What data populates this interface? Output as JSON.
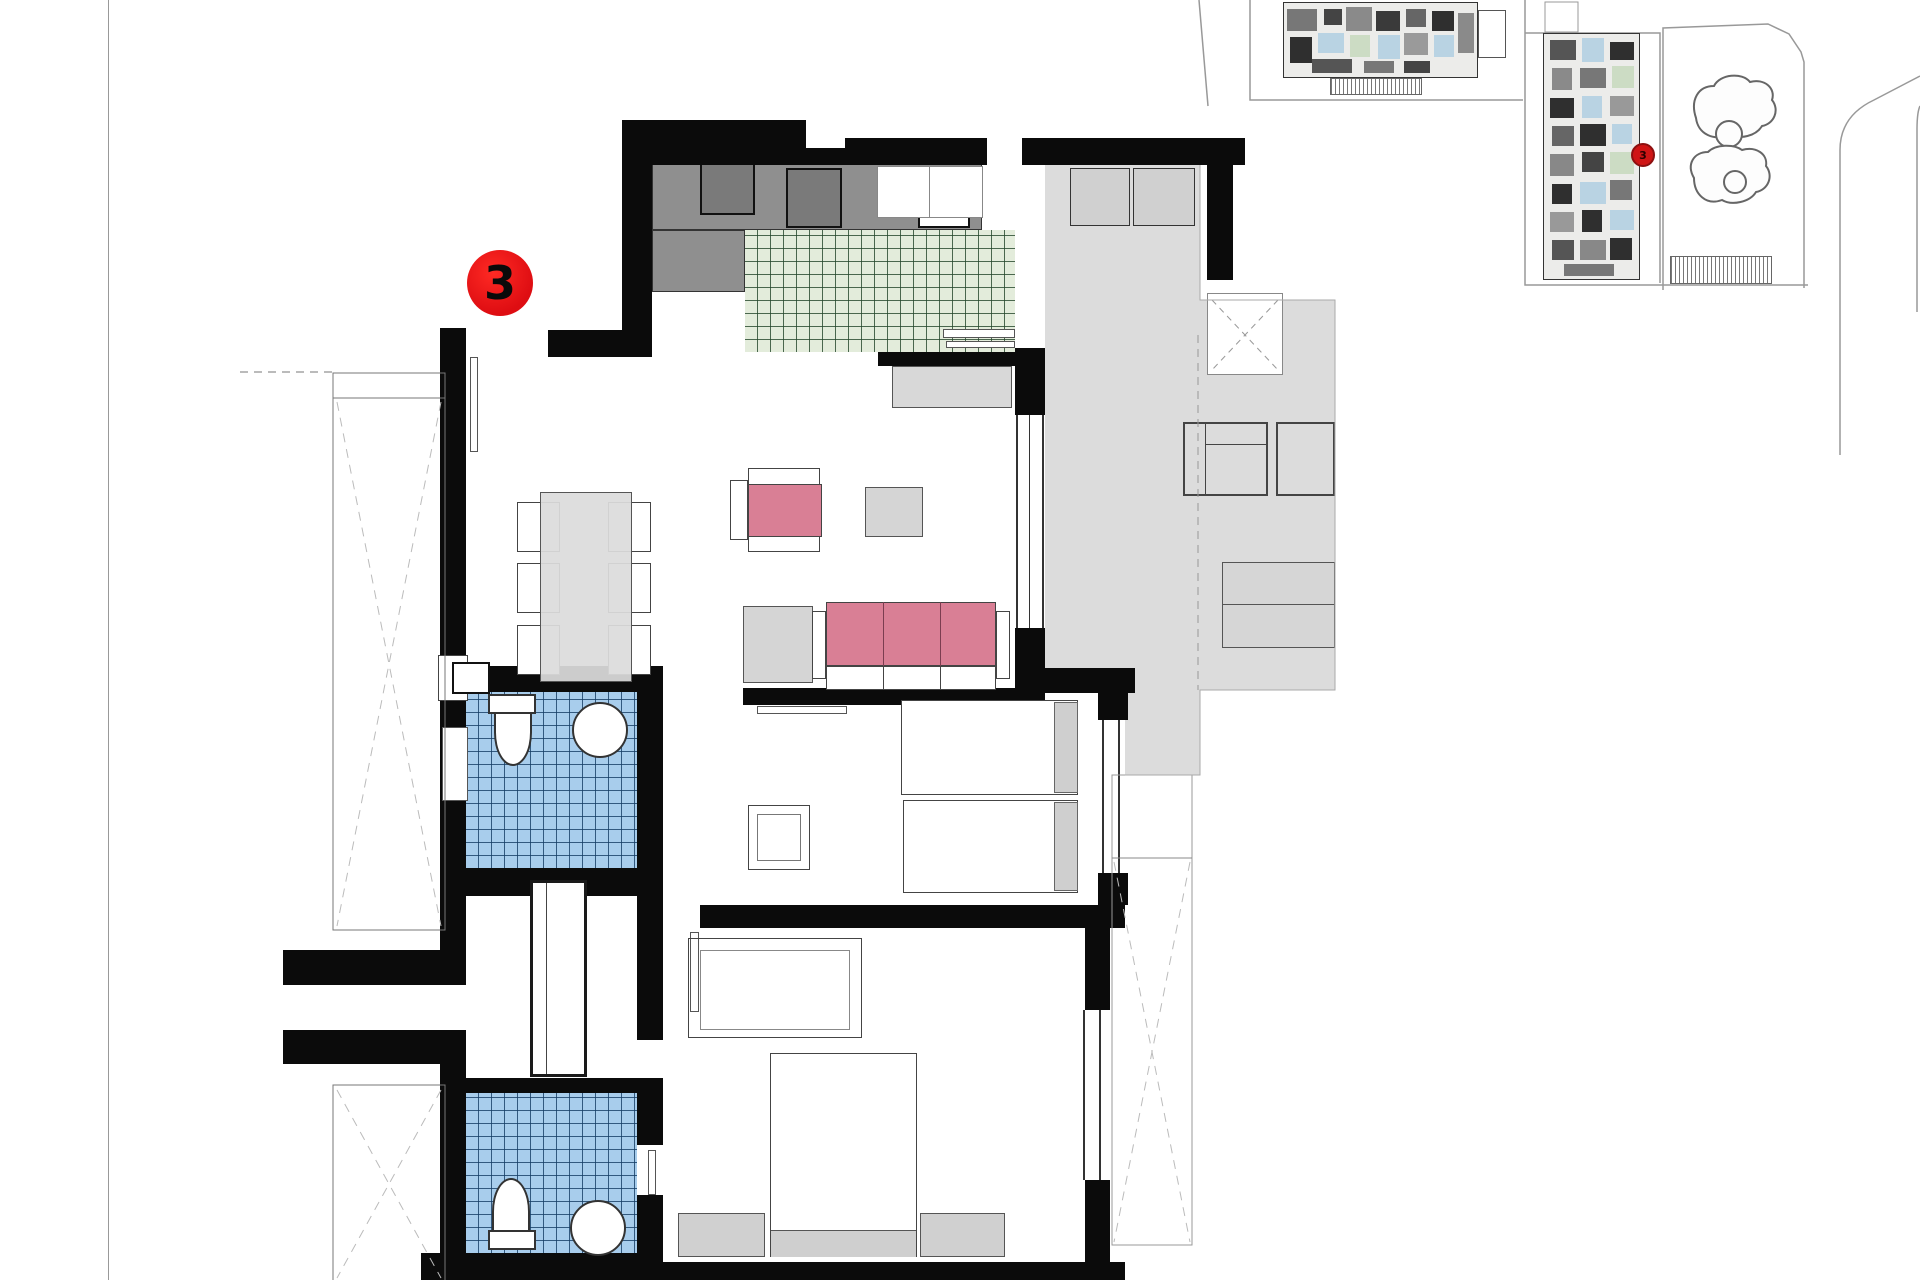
{
  "unit_badge": {
    "label": "3"
  },
  "site_plan": {
    "badge_label": "3"
  },
  "palette": {
    "wall": "#0b0b0b",
    "kitchen_tile_green": "#e3ecdb",
    "bathroom_tile_blue": "#a8cdec",
    "terrace_gray": "#dcdcdc",
    "counter_gray": "#8f8f8f",
    "upholstery_pink": "#d97f95",
    "badge_red": "#de0d12"
  },
  "rooms": [
    {
      "name": "kitchen"
    },
    {
      "name": "living-dining"
    },
    {
      "name": "covered-terrace"
    },
    {
      "name": "open-terrace"
    },
    {
      "name": "bathroom-1"
    },
    {
      "name": "bathroom-2"
    },
    {
      "name": "bedroom-1-twin"
    },
    {
      "name": "bedroom-2-double"
    },
    {
      "name": "hall-lobby"
    },
    {
      "name": "light-well-shafts"
    }
  ],
  "furniture": [
    {
      "name": "dining-table-6-chairs"
    },
    {
      "name": "sofa-3-seat-pink"
    },
    {
      "name": "armchair-pink"
    },
    {
      "name": "coffee-tables"
    },
    {
      "name": "twin-beds"
    },
    {
      "name": "double-bed"
    },
    {
      "name": "wardrobe"
    },
    {
      "name": "kitchen-counter-appliances"
    },
    {
      "name": "terrace-lounge-chairs"
    },
    {
      "name": "toilets-and-basins"
    }
  ]
}
